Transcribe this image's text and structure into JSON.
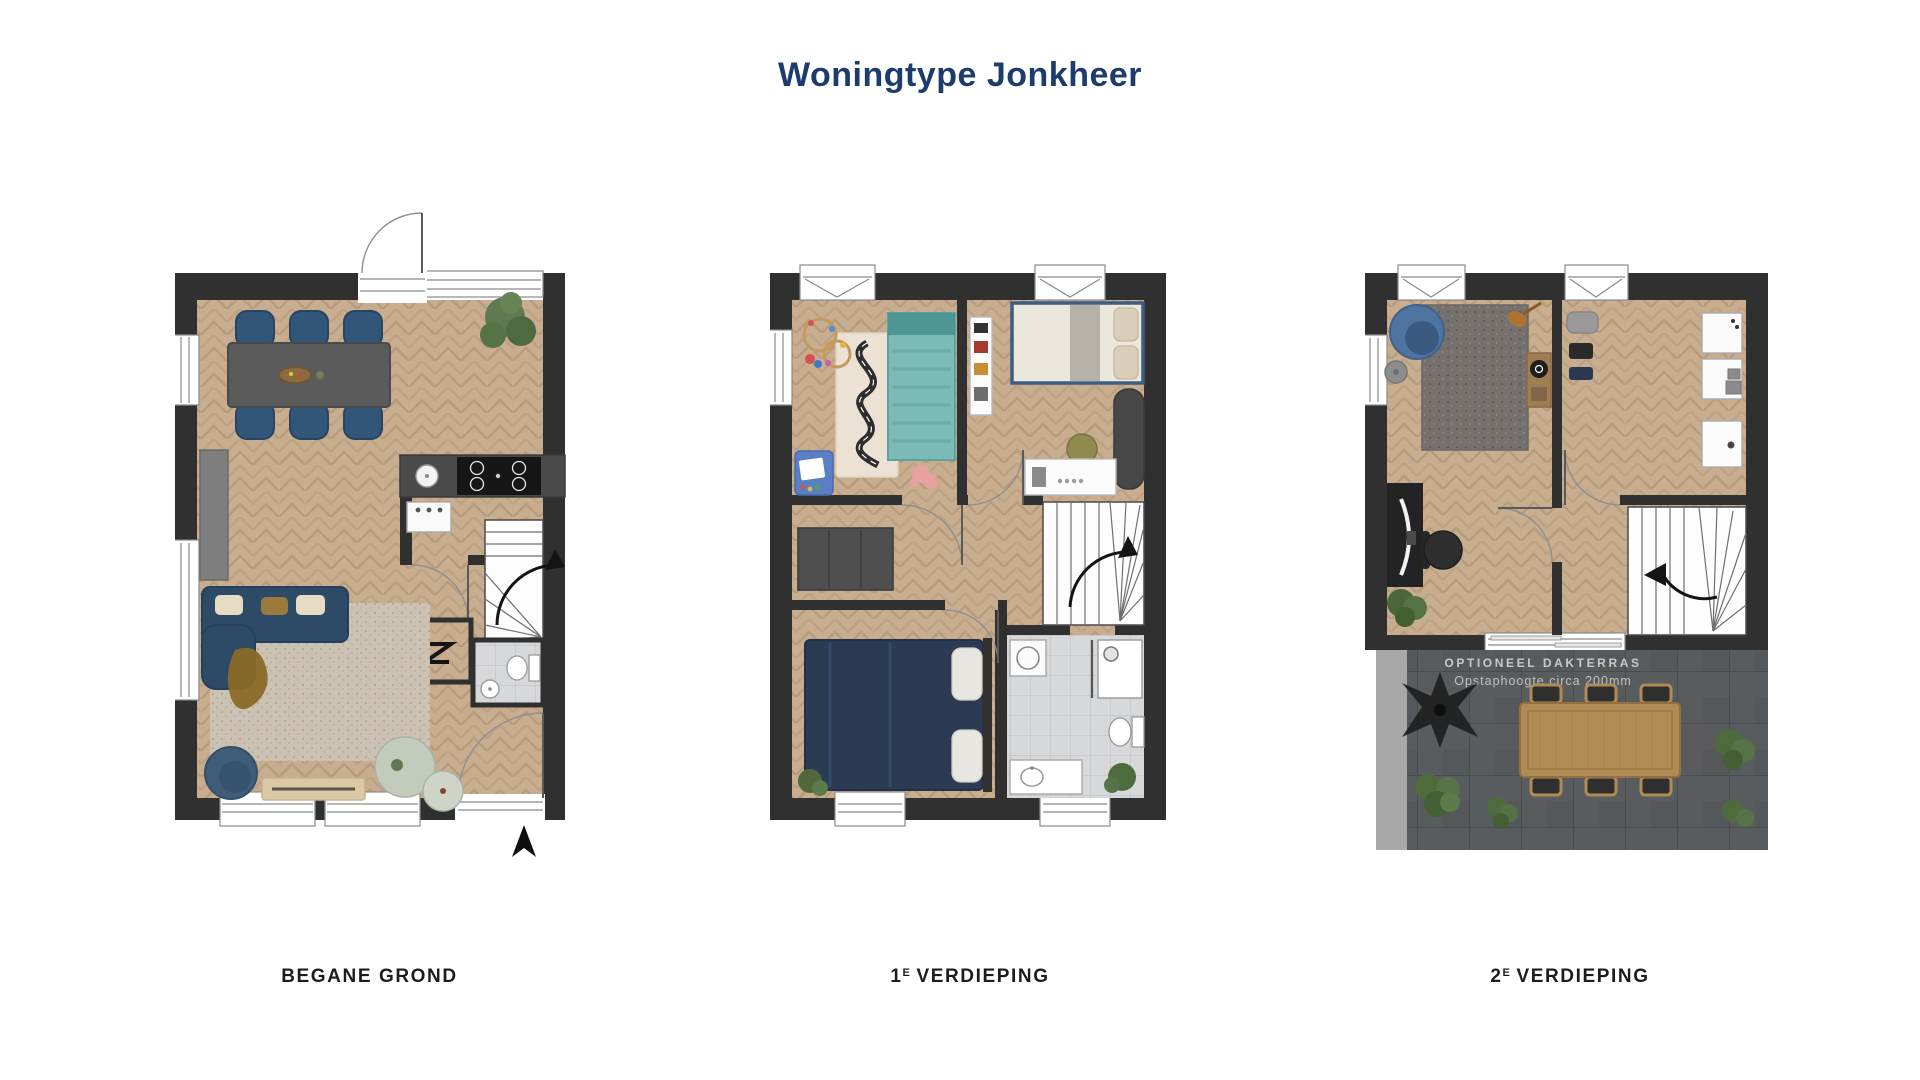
{
  "header": {
    "title": "Woningtype Jonkheer"
  },
  "floors": [
    {
      "id": "begane-grond",
      "label_prefix": "BEGANE GROND",
      "label_sup": "",
      "label_rest": "",
      "elements": [
        "entrance-door",
        "dining-table",
        "dining-chairs",
        "plant",
        "kitchen-counter",
        "cooktop",
        "kitchen-sink",
        "dishwasher",
        "staircase-up",
        "stair-direction-arrow",
        "meter-cabinet",
        "meter-cabinet-symbol",
        "toilet-room",
        "toilet",
        "washbasin",
        "hall-door",
        "back-door",
        "sofa",
        "throw-blanket",
        "rug",
        "coffee-tables",
        "lounge-pouf",
        "window-bench",
        "sideboard",
        "north-arrow"
      ]
    },
    {
      "id": "1e-verdieping",
      "label_prefix": "1",
      "label_sup": "E",
      "label_rest": "VERDIEPING",
      "elements": [
        "nursery",
        "kids-bed",
        "play-rug",
        "bead-maze-toy",
        "drawing-mat",
        "plush-toy",
        "bedroom",
        "double-bed",
        "bookshelf",
        "lounge-seat",
        "desk",
        "desk-chair",
        "landing",
        "hall-wardrobe",
        "staircase",
        "stair-direction-arrow",
        "master-bedroom",
        "master-bed",
        "bathroom",
        "shower",
        "washing-machine",
        "toilet",
        "washbasin",
        "plant"
      ]
    },
    {
      "id": "2e-verdieping",
      "label_prefix": "2",
      "label_sup": "E",
      "label_rest": "VERDIEPING",
      "elements": [
        "hobby-room",
        "lounge-chair",
        "pouf",
        "rug",
        "guitar",
        "record-player-console",
        "desk",
        "office-chair",
        "plant",
        "storage-room",
        "wall-unit",
        "equipment-cases",
        "landing",
        "staircase-down",
        "stair-direction-arrow",
        "terrace-door",
        "roof-terrace",
        "terrace-table",
        "terrace-chairs",
        "dark-palm-plant",
        "terrace-plants"
      ]
    }
  ],
  "terrace_note": {
    "line1": "OPTIONEEL DAKTERRAS",
    "line2": "Opstaphoogte circa 200mm"
  },
  "colors": {
    "title": "#1d3c6e",
    "label": "#1c1c1c",
    "wall": "#303030",
    "wood_floor": "#c8ad8e",
    "tile_floor": "#d7d8da",
    "terrace_floor": "#595c5e",
    "terrace_text": "#c9c9c9",
    "navy_furniture": "#2e4a66",
    "teal_bed": "#7cbab8"
  }
}
